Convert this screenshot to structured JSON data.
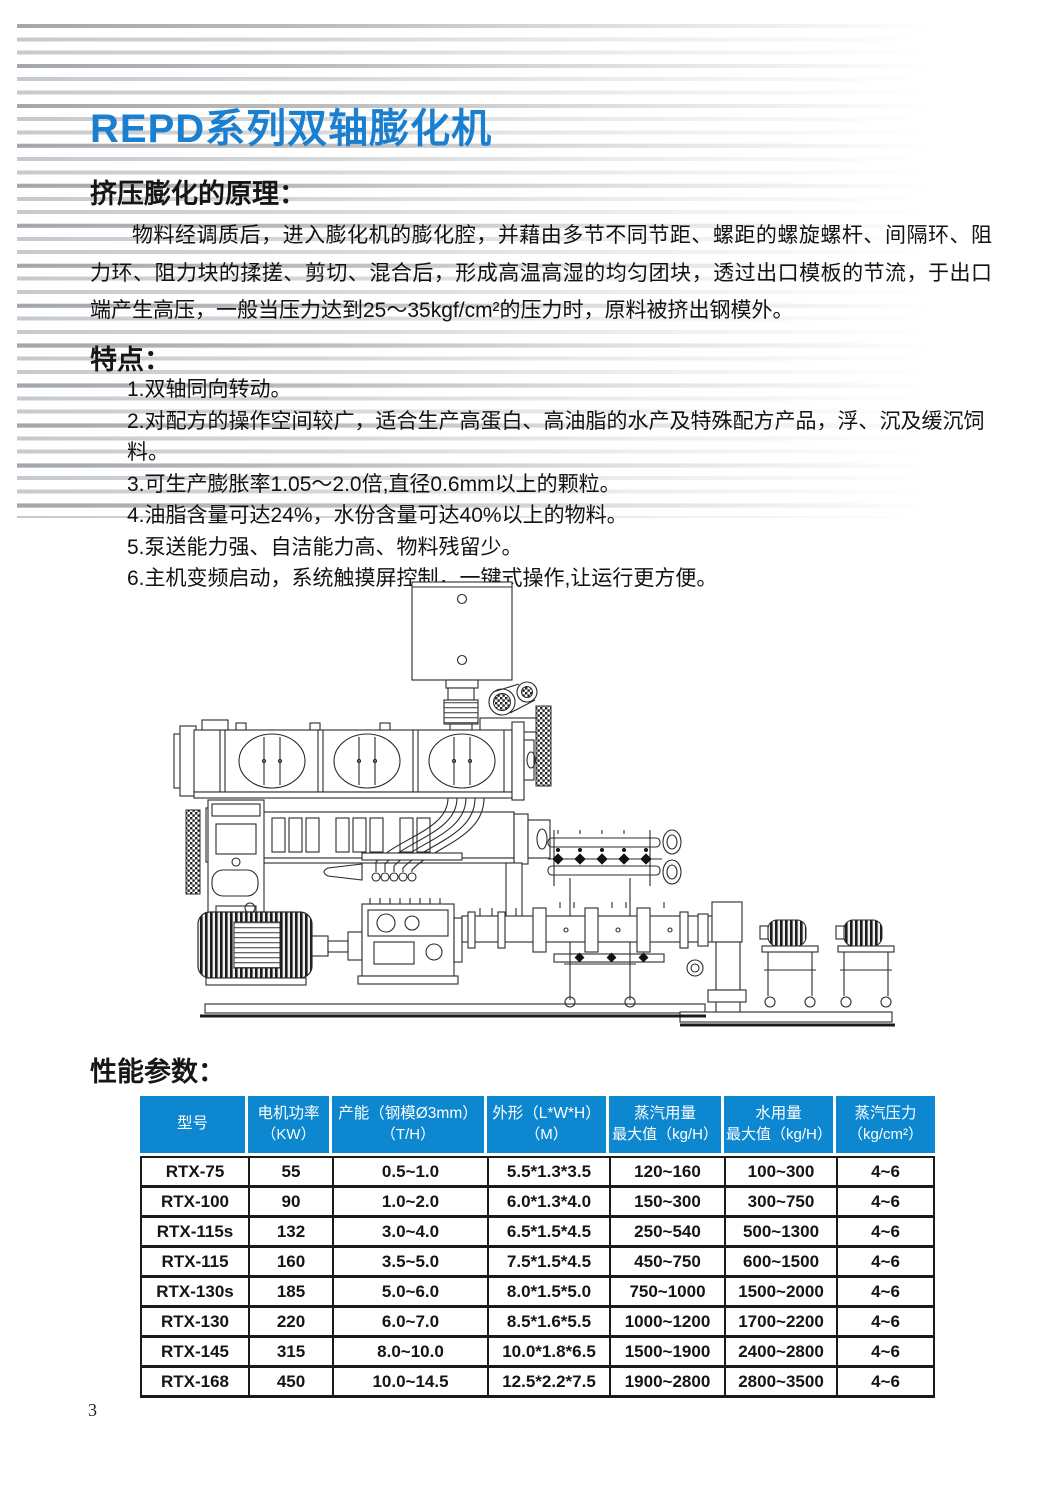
{
  "page": {
    "title": "REPD系列双轴膨化机",
    "page_number": "3",
    "accent_color": "#1b7fd0",
    "table_header_color": "#0d87cf"
  },
  "principle": {
    "heading": "挤压膨化的原理：",
    "body": "物料经调质后，进入膨化机的膨化腔，并藉由多节不同节距、螺距的螺旋螺杆、间隔环、阻力环、阻力块的揉搓、剪切、混合后，形成高温高湿的均匀团块，透过出口模板的节流，于出口端产生高压，一般当压力达到25～35kgf/cm²的压力时，原料被挤出钢模外。"
  },
  "features": {
    "heading": "特点：",
    "items": [
      "1.双轴同向转动。",
      "2.对配方的操作空间较广，适合生产高蛋白、高油脂的水产及特殊配方产品，浮、沉及缓沉饲料。",
      "3.可生产膨胀率1.05～2.0倍,直径0.6mm以上的颗粒。",
      "4.油脂含量可达24%，水份含量可达40%以上的物料。",
      "5.泵送能力强、自洁能力高、物料残留少。",
      "6.主机变频启动，系统触摸屏控制，一键式操作,让运行更方便。"
    ]
  },
  "diagram": {
    "name": "twin-screw-extruder-technical-drawing"
  },
  "parameters": {
    "heading": "性能参数：",
    "table": {
      "headers": [
        {
          "line1": "型号",
          "line2": ""
        },
        {
          "line1": "电机功率",
          "line2": "（KW）"
        },
        {
          "line1": "产能（钢模Ø3mm）",
          "line2": "（T/H）"
        },
        {
          "line1": "外形（L*W*H）",
          "line2": "（M）"
        },
        {
          "line1": "蒸汽用量",
          "line2": "最大值（kg/H）"
        },
        {
          "line1": "水用量",
          "line2": "最大值（kg/H）"
        },
        {
          "line1": "蒸汽压力",
          "line2": "（kg/cm²）"
        }
      ],
      "rows": [
        [
          "RTX-75",
          "55",
          "0.5~1.0",
          "5.5*1.3*3.5",
          "120~160",
          "100~300",
          "4~6"
        ],
        [
          "RTX-100",
          "90",
          "1.0~2.0",
          "6.0*1.3*4.0",
          "150~300",
          "300~750",
          "4~6"
        ],
        [
          "RTX-115s",
          "132",
          "3.0~4.0",
          "6.5*1.5*4.5",
          "250~540",
          "500~1300",
          "4~6"
        ],
        [
          "RTX-115",
          "160",
          "3.5~5.0",
          "7.5*1.5*4.5",
          "450~750",
          "600~1500",
          "4~6"
        ],
        [
          "RTX-130s",
          "185",
          "5.0~6.0",
          "8.0*1.5*5.0",
          "750~1000",
          "1500~2000",
          "4~6"
        ],
        [
          "RTX-130",
          "220",
          "6.0~7.0",
          "8.5*1.6*5.5",
          "1000~1200",
          "1700~2200",
          "4~6"
        ],
        [
          "RTX-145",
          "315",
          "8.0~10.0",
          "10.0*1.8*6.5",
          "1500~1900",
          "2400~2800",
          "4~6"
        ],
        [
          "RTX-168",
          "450",
          "10.0~14.5",
          "12.5*2.2*7.5",
          "1900~2800",
          "2800~3500",
          "4~6"
        ]
      ]
    }
  }
}
